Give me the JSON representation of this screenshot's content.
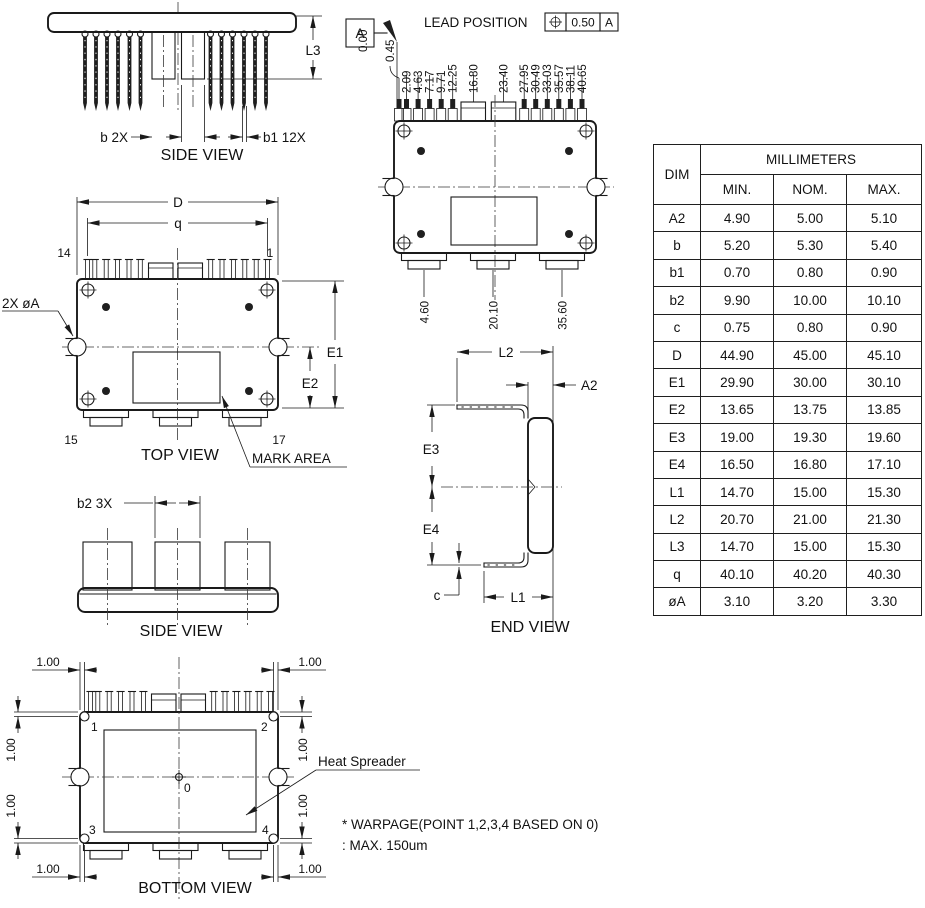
{
  "views": {
    "side_view_top": {
      "caption": "SIDE VIEW",
      "dim_l3": "L3",
      "dim_b": "b 2X",
      "dim_b1": "b1 12X"
    },
    "lead_view": {
      "datum_label": "A",
      "title": "LEAD POSITION",
      "tolerance": "0.50",
      "tolerance_datum": "A",
      "lead_positions": [
        "0.00",
        "0.45",
        "2.09",
        "4.63",
        "7.17",
        "9.71",
        "12.25",
        "16.80",
        "23.40",
        "27.95",
        "30.49",
        "33.03",
        "35.57",
        "38.11",
        "40.65"
      ],
      "tab_positions": [
        "4.60",
        "20.10",
        "35.60"
      ]
    },
    "top_view": {
      "caption": "TOP VIEW",
      "dim_d": "D",
      "dim_q": "q",
      "pin_top_left": "14",
      "pin_top_right": "1",
      "pin_bottom_left": "15",
      "pin_bottom_right": "17",
      "hole_label": "2X øA",
      "dim_e1": "E1",
      "dim_e2": "E2",
      "mark_area": "MARK AREA"
    },
    "end_view": {
      "caption": "END VIEW",
      "dim_l2": "L2",
      "dim_a2": "A2",
      "dim_e3": "E3",
      "dim_e4": "E4",
      "dim_c": "c",
      "dim_l1": "L1"
    },
    "side_view_bottom": {
      "caption": "SIDE VIEW",
      "dim_b2": "b2 3X"
    },
    "bottom_view": {
      "caption": "BOTTOM VIEW",
      "corner_dim": "1.00",
      "point_1": "1",
      "point_2": "2",
      "point_3": "3",
      "point_4": "4",
      "point_0": "0",
      "heat_spreader": "Heat Spreader",
      "note_line1": "* WARPAGE(POINT 1,2,3,4 BASED ON 0)",
      "note_line2": ": MAX. 150um"
    }
  },
  "table": {
    "title": "MILLIMETERS",
    "columns": [
      "DIM",
      "MIN.",
      "NOM.",
      "MAX."
    ],
    "rows": [
      [
        "A2",
        "4.90",
        "5.00",
        "5.10"
      ],
      [
        "b",
        "5.20",
        "5.30",
        "5.40"
      ],
      [
        "b1",
        "0.70",
        "0.80",
        "0.90"
      ],
      [
        "b2",
        "9.90",
        "10.00",
        "10.10"
      ],
      [
        "c",
        "0.75",
        "0.80",
        "0.90"
      ],
      [
        "D",
        "44.90",
        "45.00",
        "45.10"
      ],
      [
        "E1",
        "29.90",
        "30.00",
        "30.10"
      ],
      [
        "E2",
        "13.65",
        "13.75",
        "13.85"
      ],
      [
        "E3",
        "19.00",
        "19.30",
        "19.60"
      ],
      [
        "E4",
        "16.50",
        "16.80",
        "17.10"
      ],
      [
        "L1",
        "14.70",
        "15.00",
        "15.30"
      ],
      [
        "L2",
        "20.70",
        "21.00",
        "21.30"
      ],
      [
        "L3",
        "14.70",
        "15.00",
        "15.30"
      ],
      [
        "q",
        "40.10",
        "40.20",
        "40.30"
      ],
      [
        "øA",
        "3.10",
        "3.20",
        "3.30"
      ]
    ]
  }
}
